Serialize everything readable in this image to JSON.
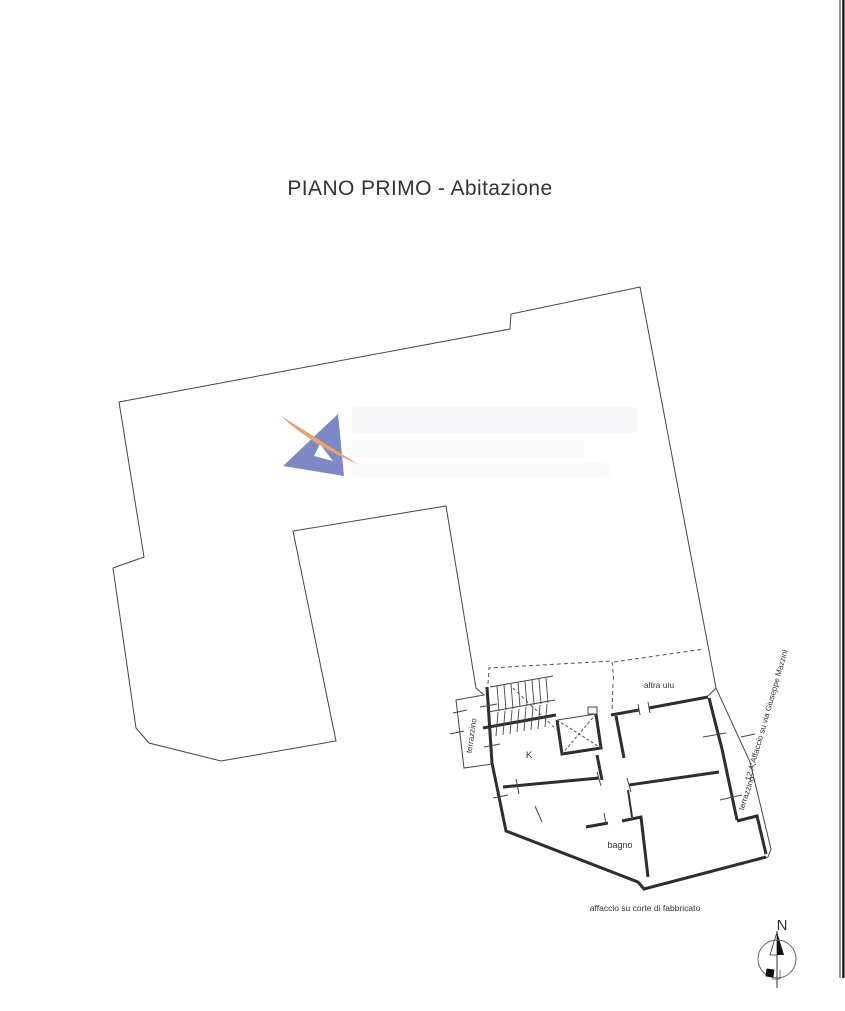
{
  "title": "PIANO PRIMO - Abitazione",
  "plan": {
    "labels": {
      "other_unit": "altra uiu",
      "kitchen": "K",
      "bathroom": "bagno",
      "terrace_left": "terrazzino",
      "terrace_right": "terrazzino",
      "courtyard_side": "affaccio su corte di fabbricato",
      "street_side": "12.A;Affaccio su via Giuseppe Mazzini"
    },
    "compass": {
      "north": "N"
    }
  },
  "colors": {
    "line": "#474747",
    "wall": "#2e2e2e",
    "logo_blue": "#7d88c5",
    "logo_orange": "#eca26e"
  }
}
